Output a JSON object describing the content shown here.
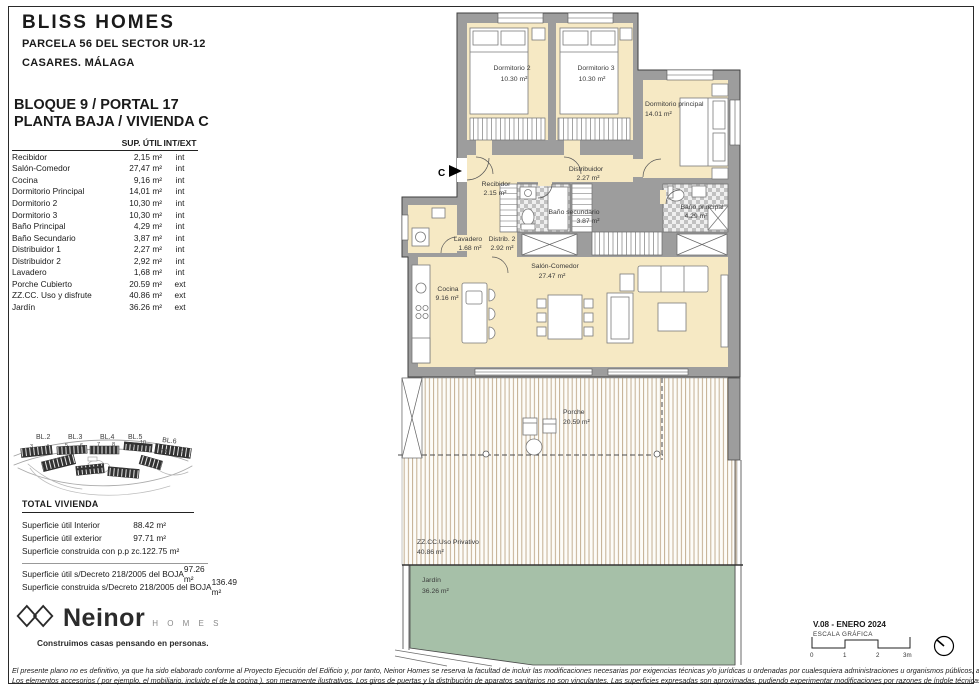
{
  "header": {
    "brand": "BLISS HOMES",
    "line1": "PARCELA 56 DEL SECTOR UR-12",
    "line2": "CASARES. MÁLAGA"
  },
  "unit": {
    "line1": "BLOQUE 9 / PORTAL 17",
    "line2": "PLANTA BAJA / VIVIENDA C"
  },
  "areas": {
    "col_sup": "SUP. ÚTIL",
    "col_intext": "INT/EXT",
    "rows": [
      {
        "name": "Recibidor",
        "value": "2,15 m²",
        "type": "int"
      },
      {
        "name": "Salón-Comedor",
        "value": "27,47 m²",
        "type": "int"
      },
      {
        "name": "Cocina",
        "value": "9,16 m²",
        "type": "int"
      },
      {
        "name": "Dormitorio Principal",
        "value": "14,01 m²",
        "type": "int"
      },
      {
        "name": "Dormitorio 2",
        "value": "10,30 m²",
        "type": "int"
      },
      {
        "name": "Dormitorio 3",
        "value": "10,30 m²",
        "type": "int"
      },
      {
        "name": "Baño Principal",
        "value": "4,29 m²",
        "type": "int"
      },
      {
        "name": "Baño Secundario",
        "value": "3,87 m²",
        "type": "int"
      },
      {
        "name": "Distribuidor 1",
        "value": "2,27 m²",
        "type": "int"
      },
      {
        "name": "Distribuidor 2",
        "value": "2,92 m²",
        "type": "int"
      },
      {
        "name": "Lavadero",
        "value": "1,68 m²",
        "type": "int"
      },
      {
        "name": "Porche Cubierto",
        "value": "20.59 m²",
        "type": "ext"
      },
      {
        "name": "ZZ.CC. Uso y disfrute",
        "value": "40.86 m²",
        "type": "ext"
      },
      {
        "name": "Jardín",
        "value": "36.26 m²",
        "type": "ext"
      }
    ]
  },
  "totals": {
    "title": "TOTAL VIVIENDA",
    "rows": [
      {
        "name": "Superficie útil Interior",
        "value": "88.42 m²"
      },
      {
        "name": "Superficie útil exterior",
        "value": "97.71 m²"
      },
      {
        "name": "Superficie construida con p.p zc.",
        "value": "122.75 m²"
      }
    ],
    "decreto": [
      {
        "name": "Superficie útil s/Decreto 218/2005 del BOJA",
        "value": "97.26 m²"
      },
      {
        "name": "Superficie construida s/Decreto 218/2005 del BOJA",
        "value": "136.49 m²"
      }
    ]
  },
  "logo": {
    "name": "Neinor",
    "sub": "H O M E S",
    "tagline": "Construimos casas pensando en personas."
  },
  "plan": {
    "section_marker": "C",
    "rooms": {
      "dorm2": {
        "label": "Dormitorio 2",
        "area": "10.30 m²"
      },
      "dorm3": {
        "label": "Dormitorio 3",
        "area": "10.30 m²"
      },
      "principal": {
        "label": "Dormitorio principal",
        "area": "14.01 m²"
      },
      "distribuidor": {
        "label": "Distribuidor",
        "area": "2.27 m²"
      },
      "recibidor": {
        "label": "Recibidor",
        "area": "2.15 m²"
      },
      "banosec": {
        "label": "Baño secundario",
        "area": "3.87 m²"
      },
      "banoppal": {
        "label": "Baño principal",
        "area": "4.29 m²"
      },
      "lavadero": {
        "label": "Lavadero",
        "area": "1.68 m²"
      },
      "distrib2": {
        "label": "Distrib. 2",
        "area": "2.92 m²"
      },
      "salon": {
        "label": "Salón-Comedor",
        "area": "27.47 m²"
      },
      "cocina": {
        "label": "Cocina",
        "area": "9.16 m²"
      },
      "porche": {
        "label": "Porche",
        "area": "20.59 m²"
      },
      "zzcc": {
        "label": "ZZ.CC.Uso Privativo",
        "area": "40.86 m²"
      },
      "jardin": {
        "label": "Jardín",
        "area": "36.26 m²"
      }
    },
    "colors": {
      "room_fill": "#f6e9c4",
      "wall_gray": "#9d9d9d",
      "garden_green": "#a6c0a8",
      "deck_line": "#c3ae92"
    }
  },
  "site_map": {
    "blocks": [
      "BL.2",
      "BL.3",
      "BL.4",
      "BL.5",
      "BL.6"
    ],
    "numbers": [
      "3",
      "4",
      "5",
      "6",
      "7",
      "8",
      "9",
      "10",
      "12",
      "11"
    ]
  },
  "version": {
    "label": "V.08 - ENERO 2024",
    "scale_label": "ESCALA GRÁFICA",
    "ticks": [
      "0",
      "1",
      "2",
      "3m"
    ]
  },
  "footer": {
    "line1": "El presente plano no es definitivo, ya que ha sido elaborado conforme al Proyecto Ejecución del Edificio y, por tanto, Neinor Homes se reserva la facultad de incluir las modificaciones necesarias por exigencias técnicas y/o jurídicas u ordenadas por cualesquiera administraciones u organismos públicos, ajustándolo en todo caso al desarrollo de la ejecución de las obras.",
    "line2": "Los elementos accesorios  ( por ejemplo, el mobiliario, incluido el de la cocina ),  son meramente ilustrativos.  Los giros de puertas  y  la distribución de aparatos sanitarios no son vinculantes.  Las superficies  expresadas son aproximadas,  pudiendo  experimentar modificaciones por razones de índole técnicas y/o legal en el desarrollo de la ejecución de las obras."
  }
}
